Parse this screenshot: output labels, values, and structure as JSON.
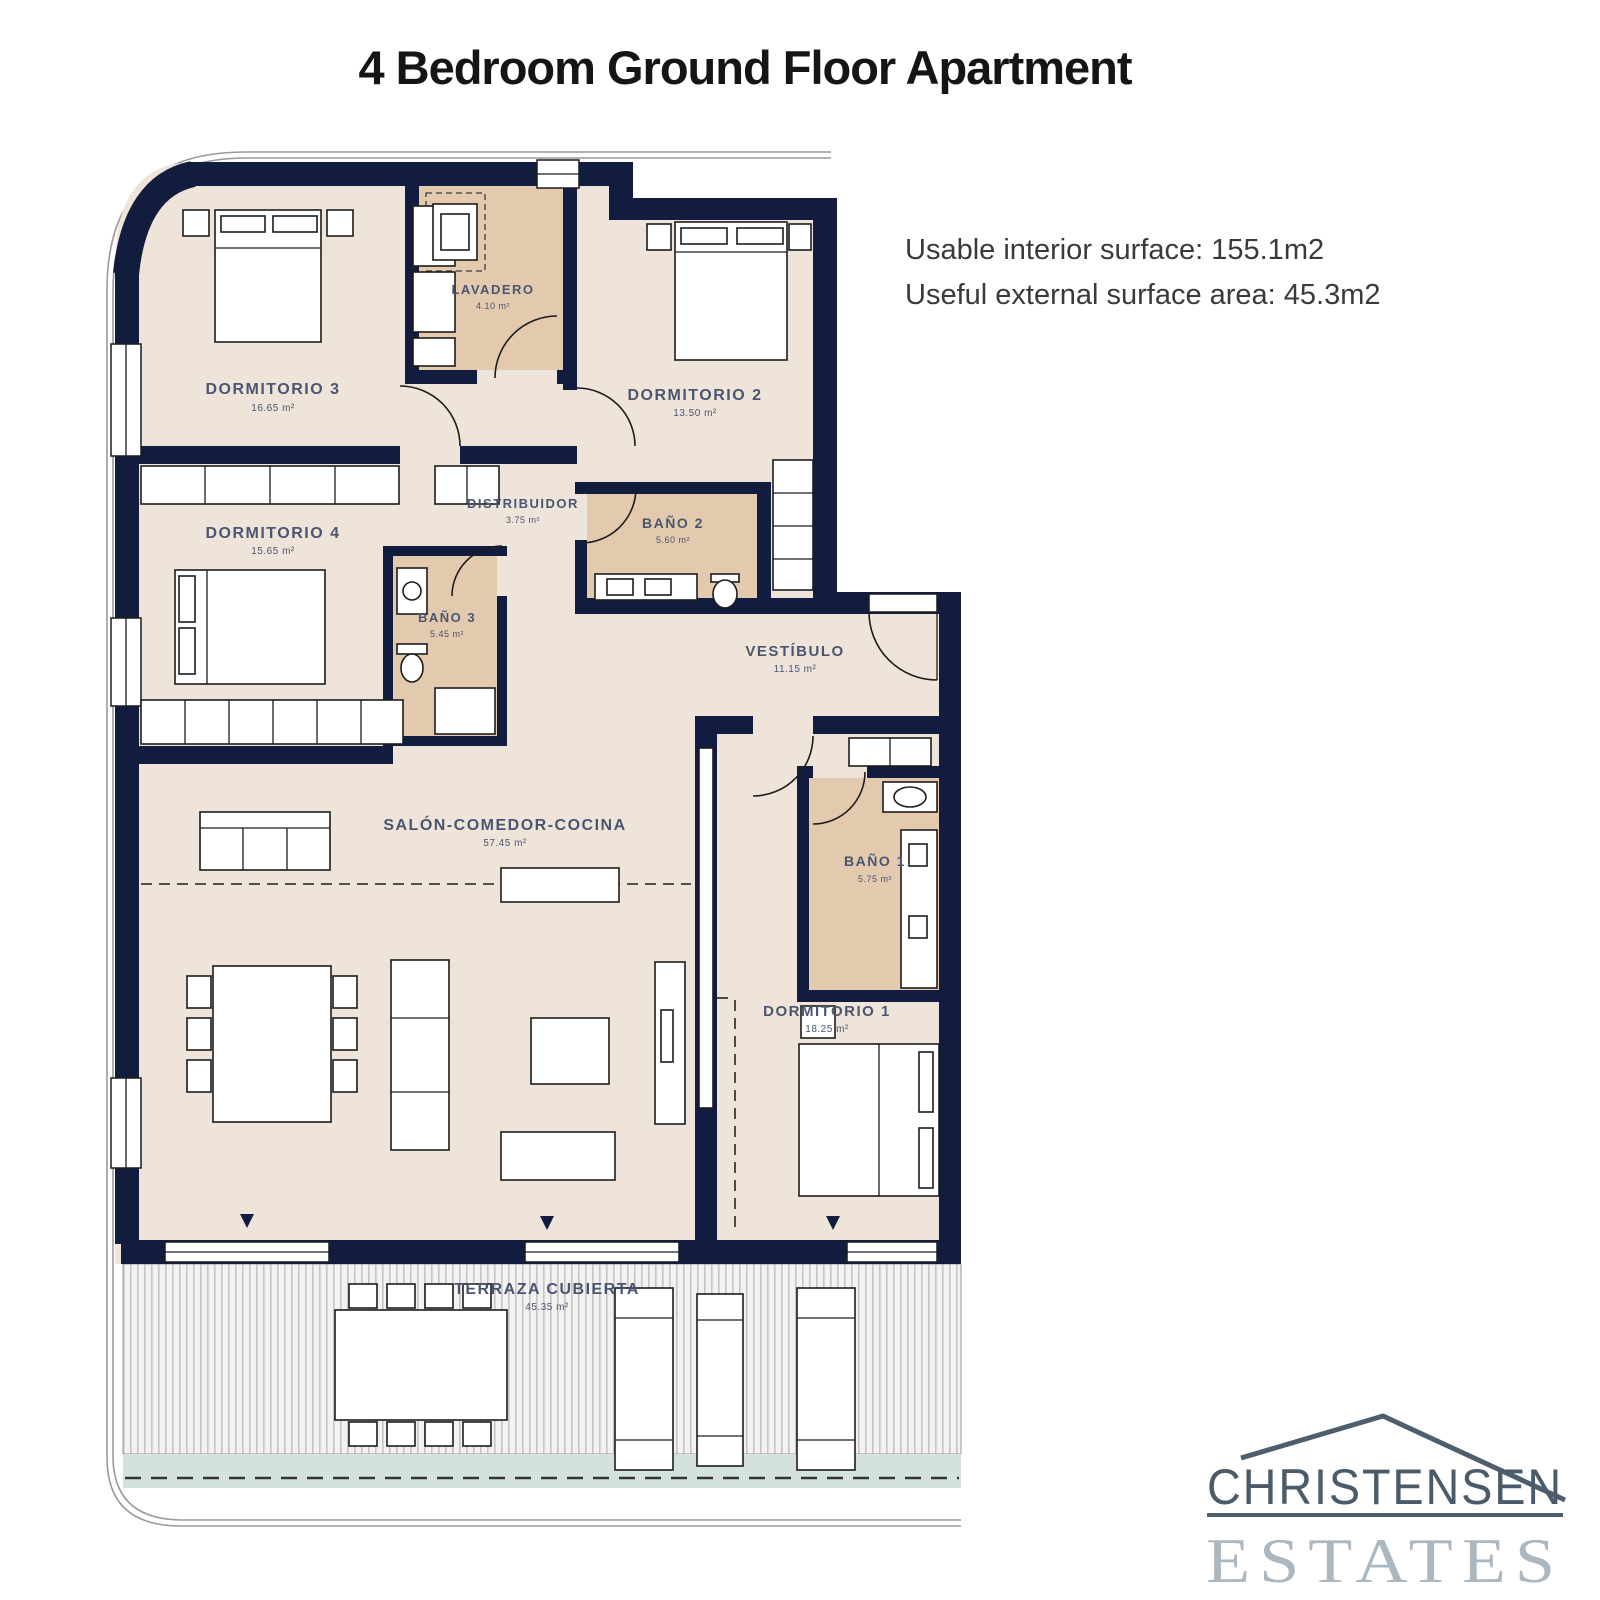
{
  "title": "4 Bedroom Ground Floor Apartment",
  "info": {
    "line1": "Usable interior surface: 155.1m2",
    "line2": "Useful external surface area: 45.3m2"
  },
  "rooms": {
    "dormitorio3": {
      "name": "DORMITORIO 3",
      "area": "16.65 m²"
    },
    "lavadero": {
      "name": "LAVADERO",
      "area": "4.10 m²"
    },
    "dormitorio2": {
      "name": "DORMITORIO 2",
      "area": "13.50 m²"
    },
    "dormitorio4": {
      "name": "DORMITORIO 4",
      "area": "15.65 m²"
    },
    "distribuidor": {
      "name": "DISTRIBUIDOR",
      "area": "3.75 m²"
    },
    "bano2": {
      "name": "BAÑO 2",
      "area": "5.60 m²"
    },
    "bano3": {
      "name": "BAÑO 3",
      "area": "5.45 m²"
    },
    "vestibulo": {
      "name": "VESTÍBULO",
      "area": "11.15 m²"
    },
    "salon": {
      "name": "SALÓN-COMEDOR-COCINA",
      "area": "57.45 m²"
    },
    "bano1": {
      "name": "BAÑO 1",
      "area": "5.75 m²"
    },
    "dormitorio1": {
      "name": "DORMITORIO 1",
      "area": "18.25 m²"
    },
    "terraza": {
      "name": "TERRAZA CUBIERTA",
      "area": "45.35 m²"
    }
  },
  "logo": {
    "top": "CHRISTENSEN",
    "bottom": "ESTATES"
  },
  "colors": {
    "wall": "#121c3e",
    "room_fill": "#efe4d9",
    "wet_room_fill": "#e3caae",
    "label_text": "#4a5670",
    "terrace_band": "#d4e2de",
    "logo_dark": "#4e5e6d",
    "logo_light": "#abb8c1"
  }
}
